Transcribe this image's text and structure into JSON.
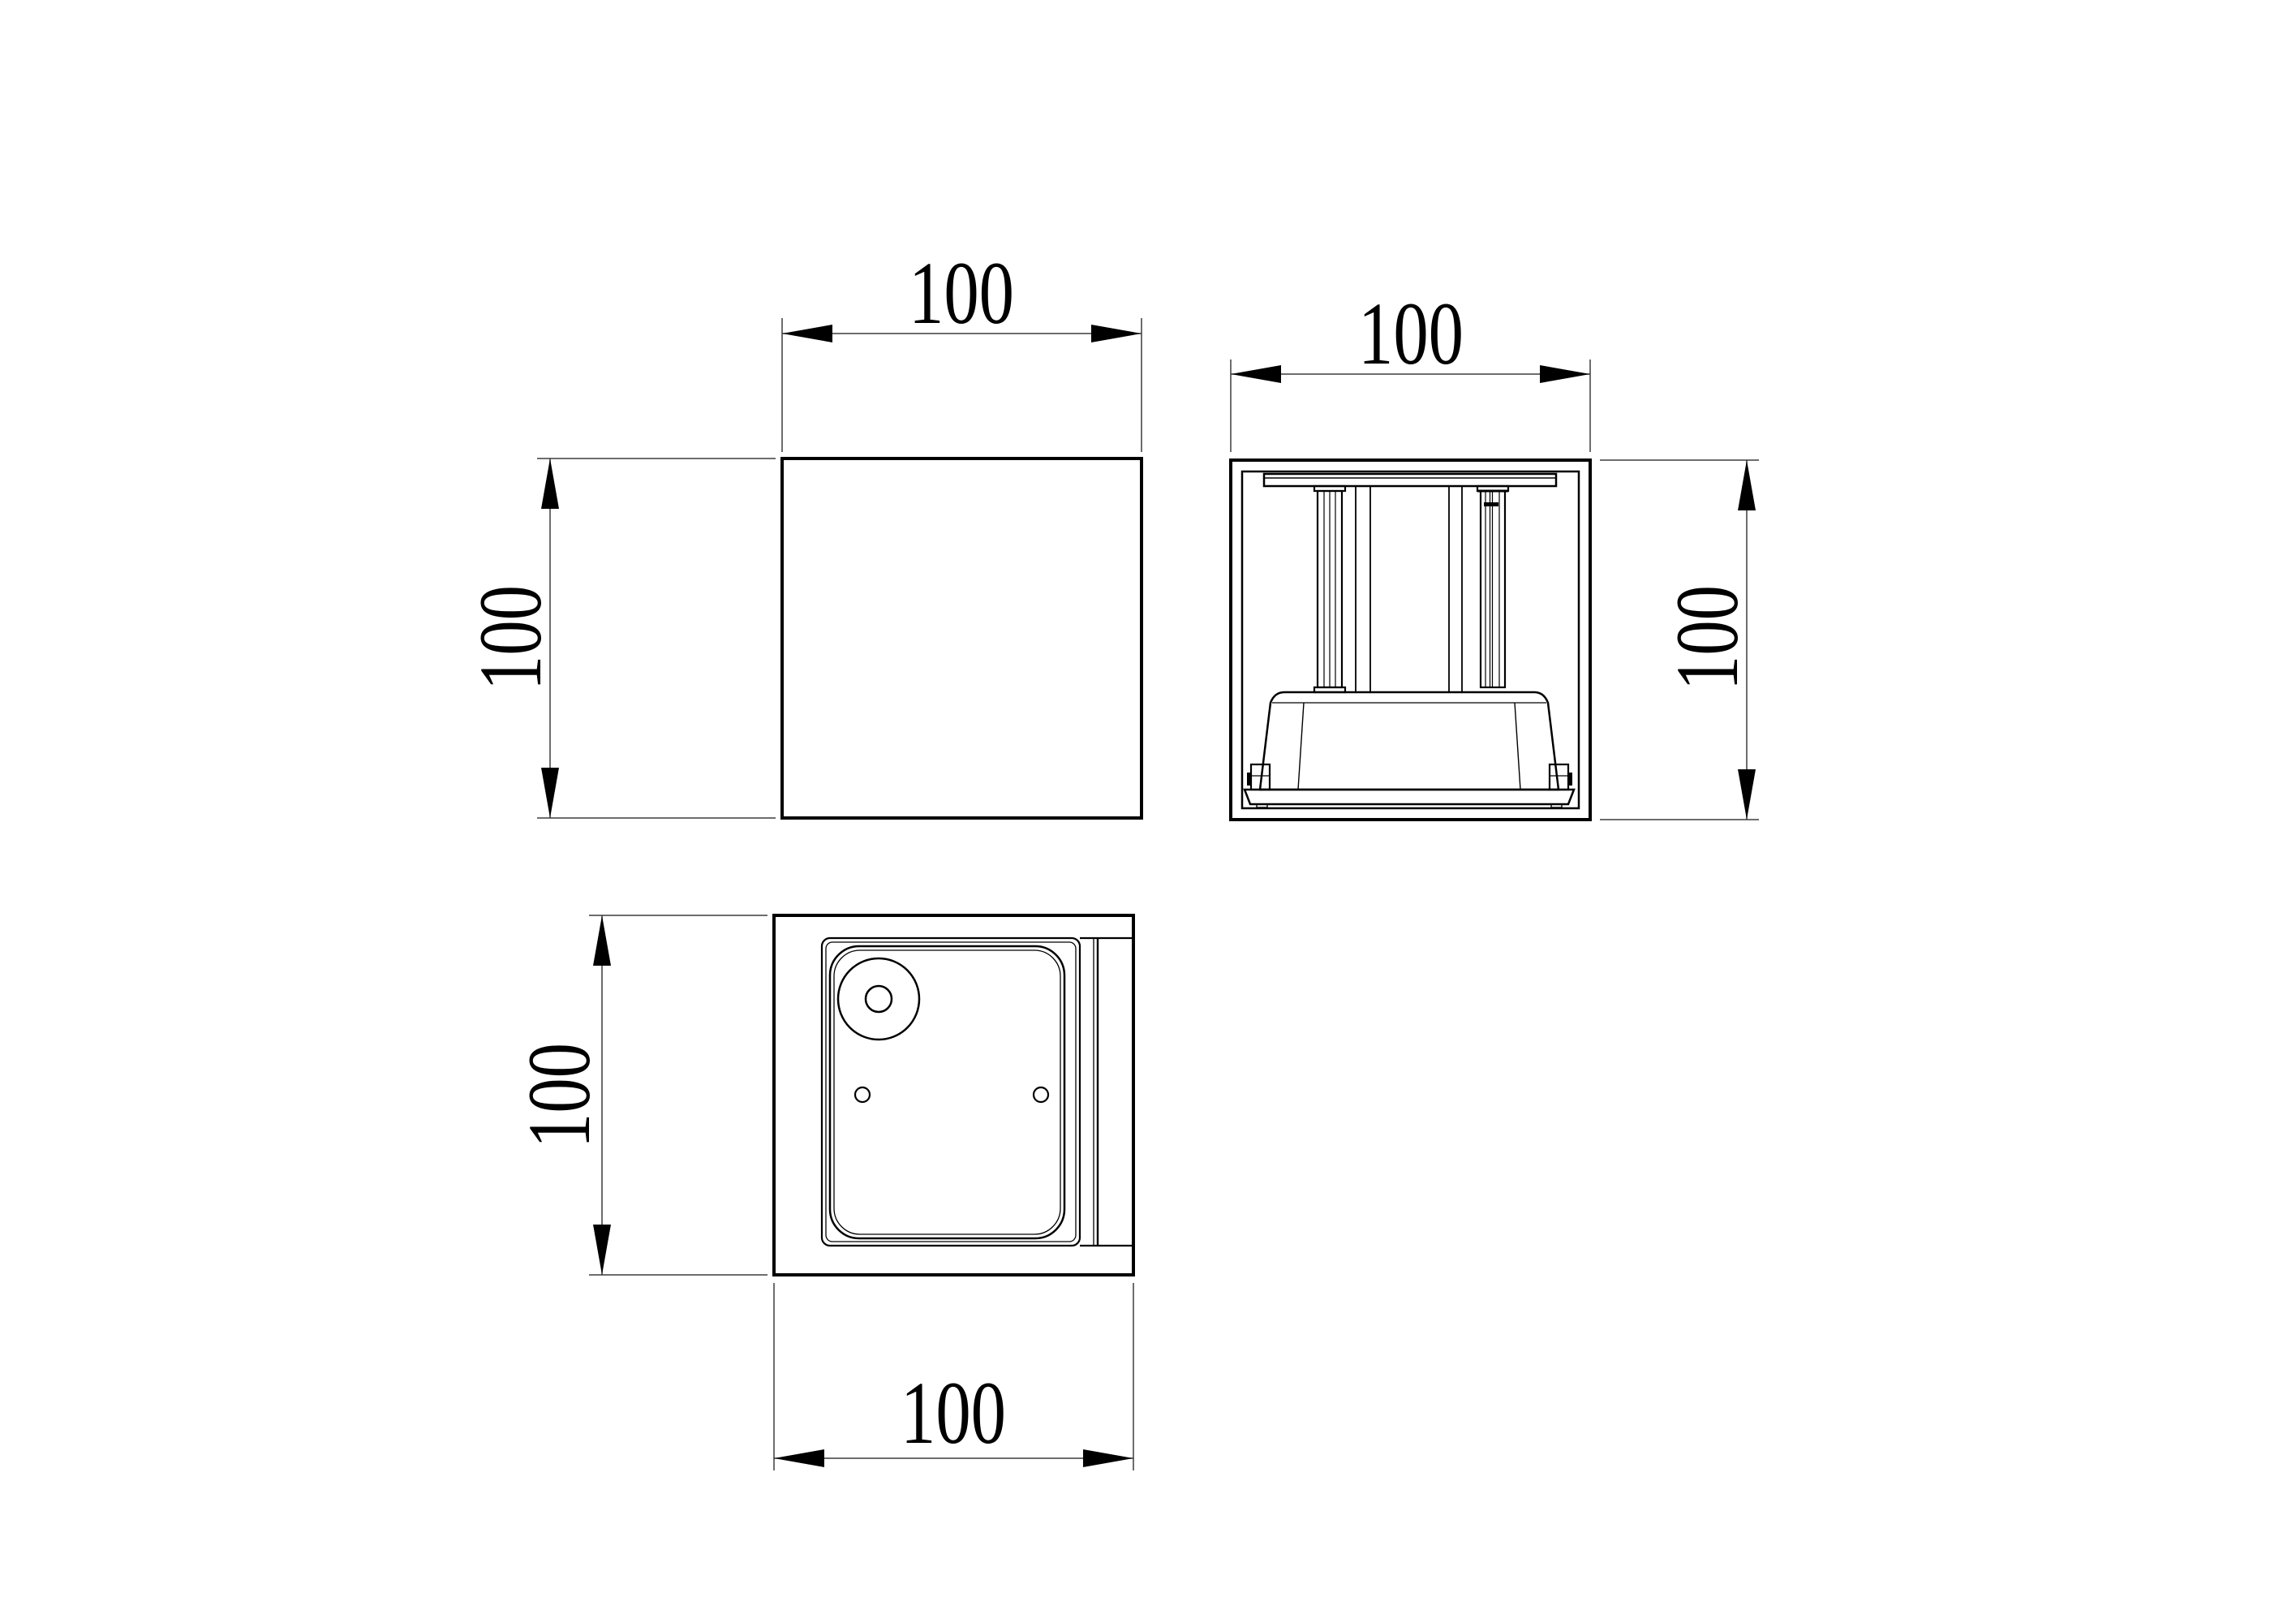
{
  "canvas": {
    "background_color": "#ffffff",
    "object_line_color": "#000000",
    "dimension_line_color": "#3d3d3d"
  },
  "views": {
    "front": {
      "description": "front elevation (plain square face)",
      "width_label": "100",
      "height_label": "100"
    },
    "side_section": {
      "description": "side section showing mounting plate, posts and driver base",
      "width_label": "100",
      "height_label": "100"
    },
    "bottom": {
      "description": "bottom face with lens panel, lamp hole and two screw holes",
      "width_label": "100",
      "height_label": "100"
    }
  }
}
